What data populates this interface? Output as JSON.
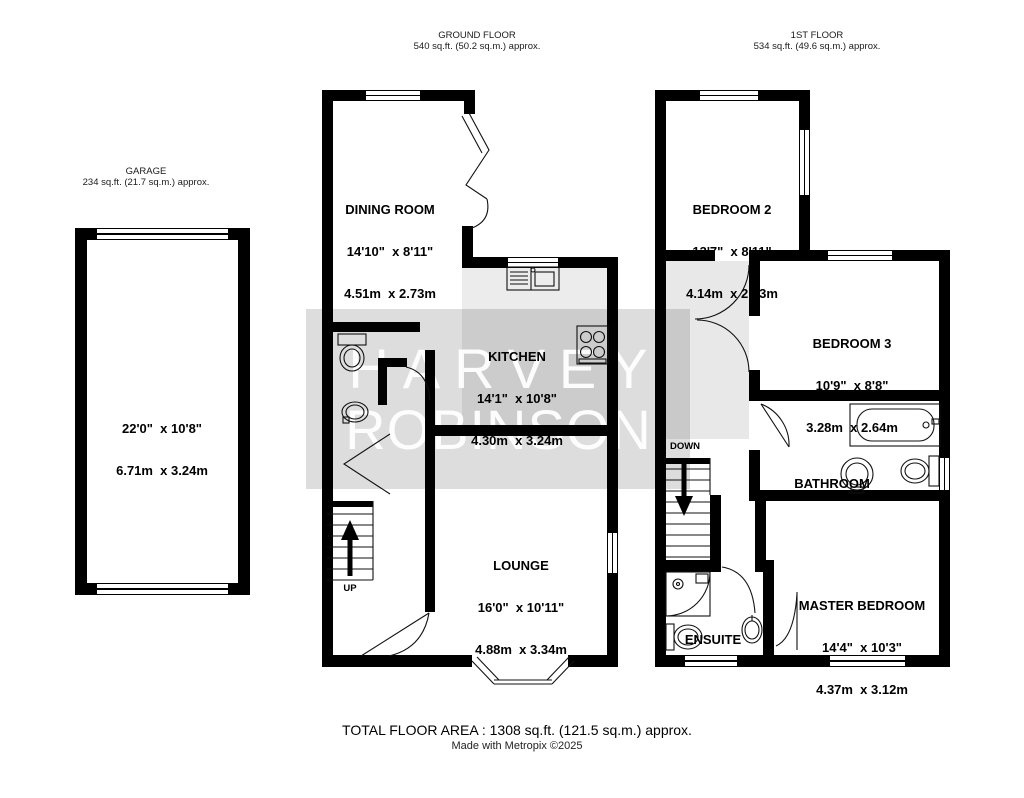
{
  "floorplan": {
    "headers": {
      "garage": {
        "title": "GARAGE",
        "area": "234 sq.ft. (21.7 sq.m.) approx."
      },
      "ground": {
        "title": "GROUND FLOOR",
        "area": "540 sq.ft. (50.2 sq.m.) approx."
      },
      "first": {
        "title": "1ST FLOOR",
        "area": "534 sq.ft. (49.6 sq.m.) approx."
      }
    },
    "rooms": {
      "garage": {
        "imperial": "22'0\"  x 10'8\"",
        "metric": "6.71m  x 3.24m"
      },
      "dining": {
        "name": "DINING ROOM",
        "imperial": "14'10\"  x 8'11\"",
        "metric": "4.51m  x 2.73m"
      },
      "kitchen": {
        "name": "KITCHEN",
        "imperial": "14'1\"  x 10'8\"",
        "metric": "4.30m  x 3.24m"
      },
      "lounge": {
        "name": "LOUNGE",
        "imperial": "16'0\"  x 10'11\"",
        "metric": "4.88m  x 3.34m"
      },
      "bedroom2": {
        "name": "BEDROOM 2",
        "imperial": "13'7\"  x 8'11\"",
        "metric": "4.14m  x 2.73m"
      },
      "bedroom3": {
        "name": "BEDROOM 3",
        "imperial": "10'9\"  x 8'8\"",
        "metric": "3.28m  x 2.64m"
      },
      "bathroom": {
        "name": "BATHROOM"
      },
      "master": {
        "name": "MASTER BEDROOM",
        "imperial": "14'4\"  x 10'3\"",
        "metric": "4.37m  x 3.12m"
      },
      "ensuite": {
        "name": "ENSUITE"
      }
    },
    "stairs": {
      "up": "UP",
      "down": "DOWN"
    },
    "watermark": {
      "line1": "HARVEY",
      "line2": "ROBINSON"
    },
    "footer": {
      "total_area": "TOTAL FLOOR AREA : 1308 sq.ft. (121.5 sq.m.) approx.",
      "credit": "Made with Metropix ©2025"
    },
    "colors": {
      "wall": "#000000",
      "watermark_band": "#d9d9d9",
      "kitchen_floor": "#ececec"
    }
  }
}
